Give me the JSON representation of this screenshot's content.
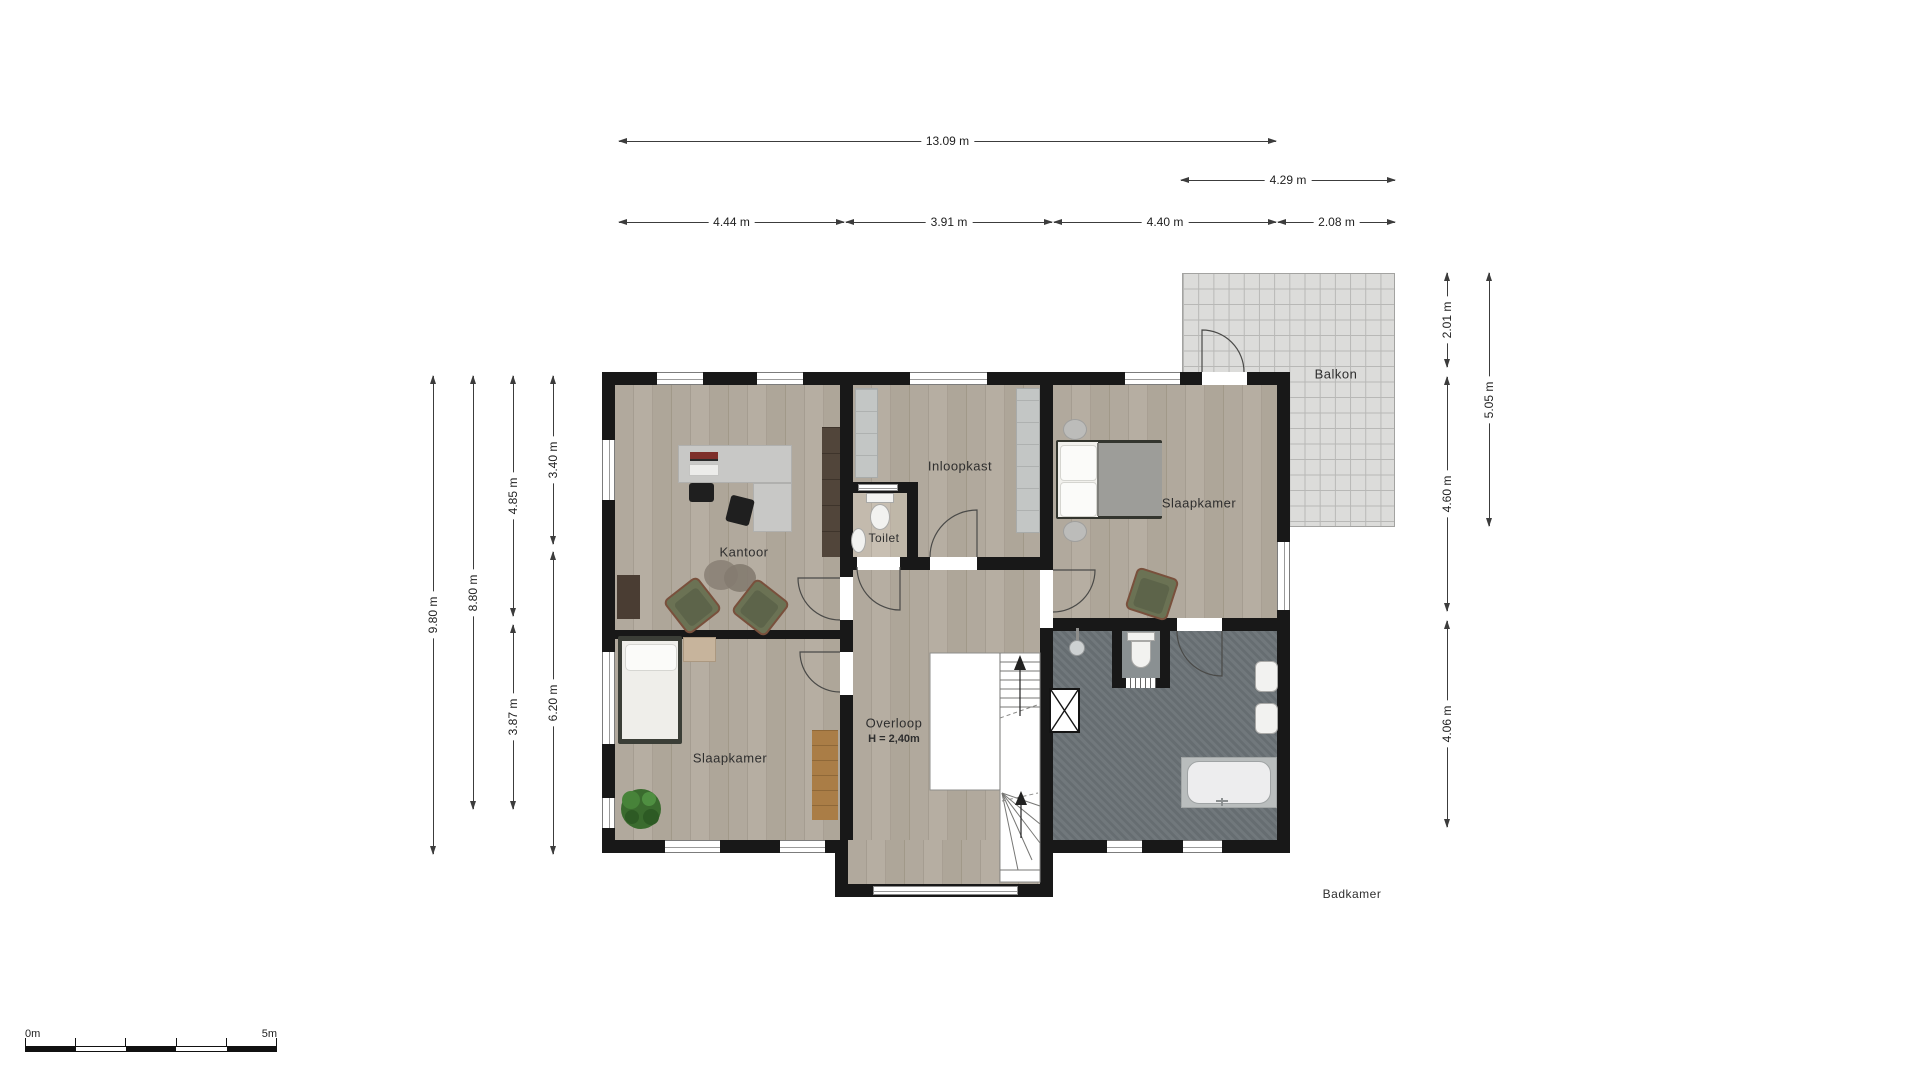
{
  "plan": {
    "type": "floor-plan",
    "floor": "upper floor"
  },
  "rooms": {
    "kantoor": {
      "label": "Kantoor"
    },
    "toilet": {
      "label": "Toilet"
    },
    "inloopkast": {
      "label": "Inloopkast"
    },
    "slaapkamer_top_right": {
      "label": "Slaapkamer"
    },
    "slaapkamer_bottom_left": {
      "label": "Slaapkamer"
    },
    "overloop": {
      "label": "Overloop",
      "ceiling_height": "H = 2,40m"
    },
    "badkamer": {
      "label": "Badkamer"
    },
    "balkon": {
      "label": "Balkon"
    }
  },
  "dimensions": {
    "top_total": "13.09 m",
    "top_balcony": "4.29 m",
    "top_segments": [
      "4.44 m",
      "3.91 m",
      "4.40 m",
      "2.08 m"
    ],
    "left_outer": "9.80 m",
    "left_inner": "8.80 m",
    "left_col3_top": "4.85 m",
    "left_col3_bottom": "3.87 m",
    "left_col4_top": "3.40 m",
    "left_col4_bottom": "6.20 m",
    "right_balcony_top": "2.01 m",
    "right_middle": "4.60 m",
    "right_bottom": "4.06 m",
    "right_balcony_height": "5.05 m"
  },
  "scale_bar": {
    "start_label": "0m",
    "end_label": "5m"
  },
  "colors": {
    "wall": "#181818",
    "wood_floor": "#aea695",
    "bathroom_floor": "#6b7377",
    "balcony_tile": "#dcdcda",
    "furniture_grey": "#c8c8c6",
    "armchair_green": "#6b7254",
    "wood_mat": "#aa7d46"
  }
}
